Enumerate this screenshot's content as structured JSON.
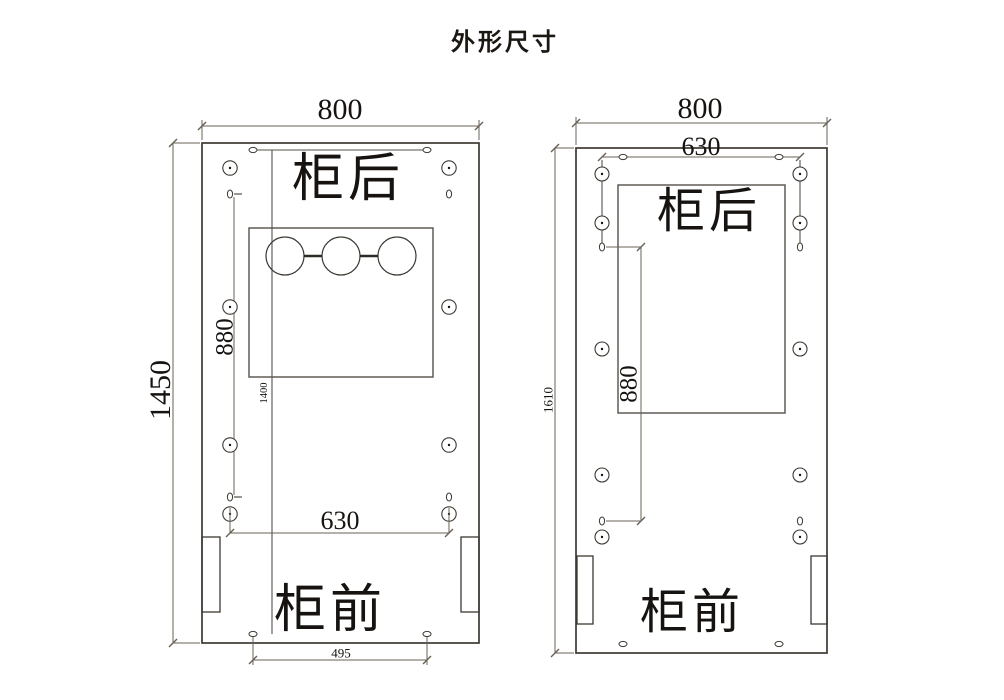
{
  "title": "外形尺寸",
  "left_drawing": {
    "name": "cabinet-base-plate-left",
    "labels": {
      "back": "柜后",
      "front": "柜前"
    },
    "dimensions": {
      "overall_width": "800",
      "overall_height": "1450",
      "hole_span_horizontal": "630",
      "hole_span_vertical": "880",
      "inner_height": "1400",
      "bottom_hole_span": "495"
    }
  },
  "right_drawing": {
    "name": "cabinet-base-plate-right",
    "labels": {
      "back": "柜后",
      "front": "柜前"
    },
    "dimensions": {
      "overall_width": "800",
      "top_hole_span": "630",
      "overall_height": "1610",
      "hole_span_vertical": "880"
    }
  },
  "colors": {
    "outline": "#3d3832",
    "dimension_line": "#6a6156",
    "text": "#161310",
    "background": "#ffffff"
  }
}
